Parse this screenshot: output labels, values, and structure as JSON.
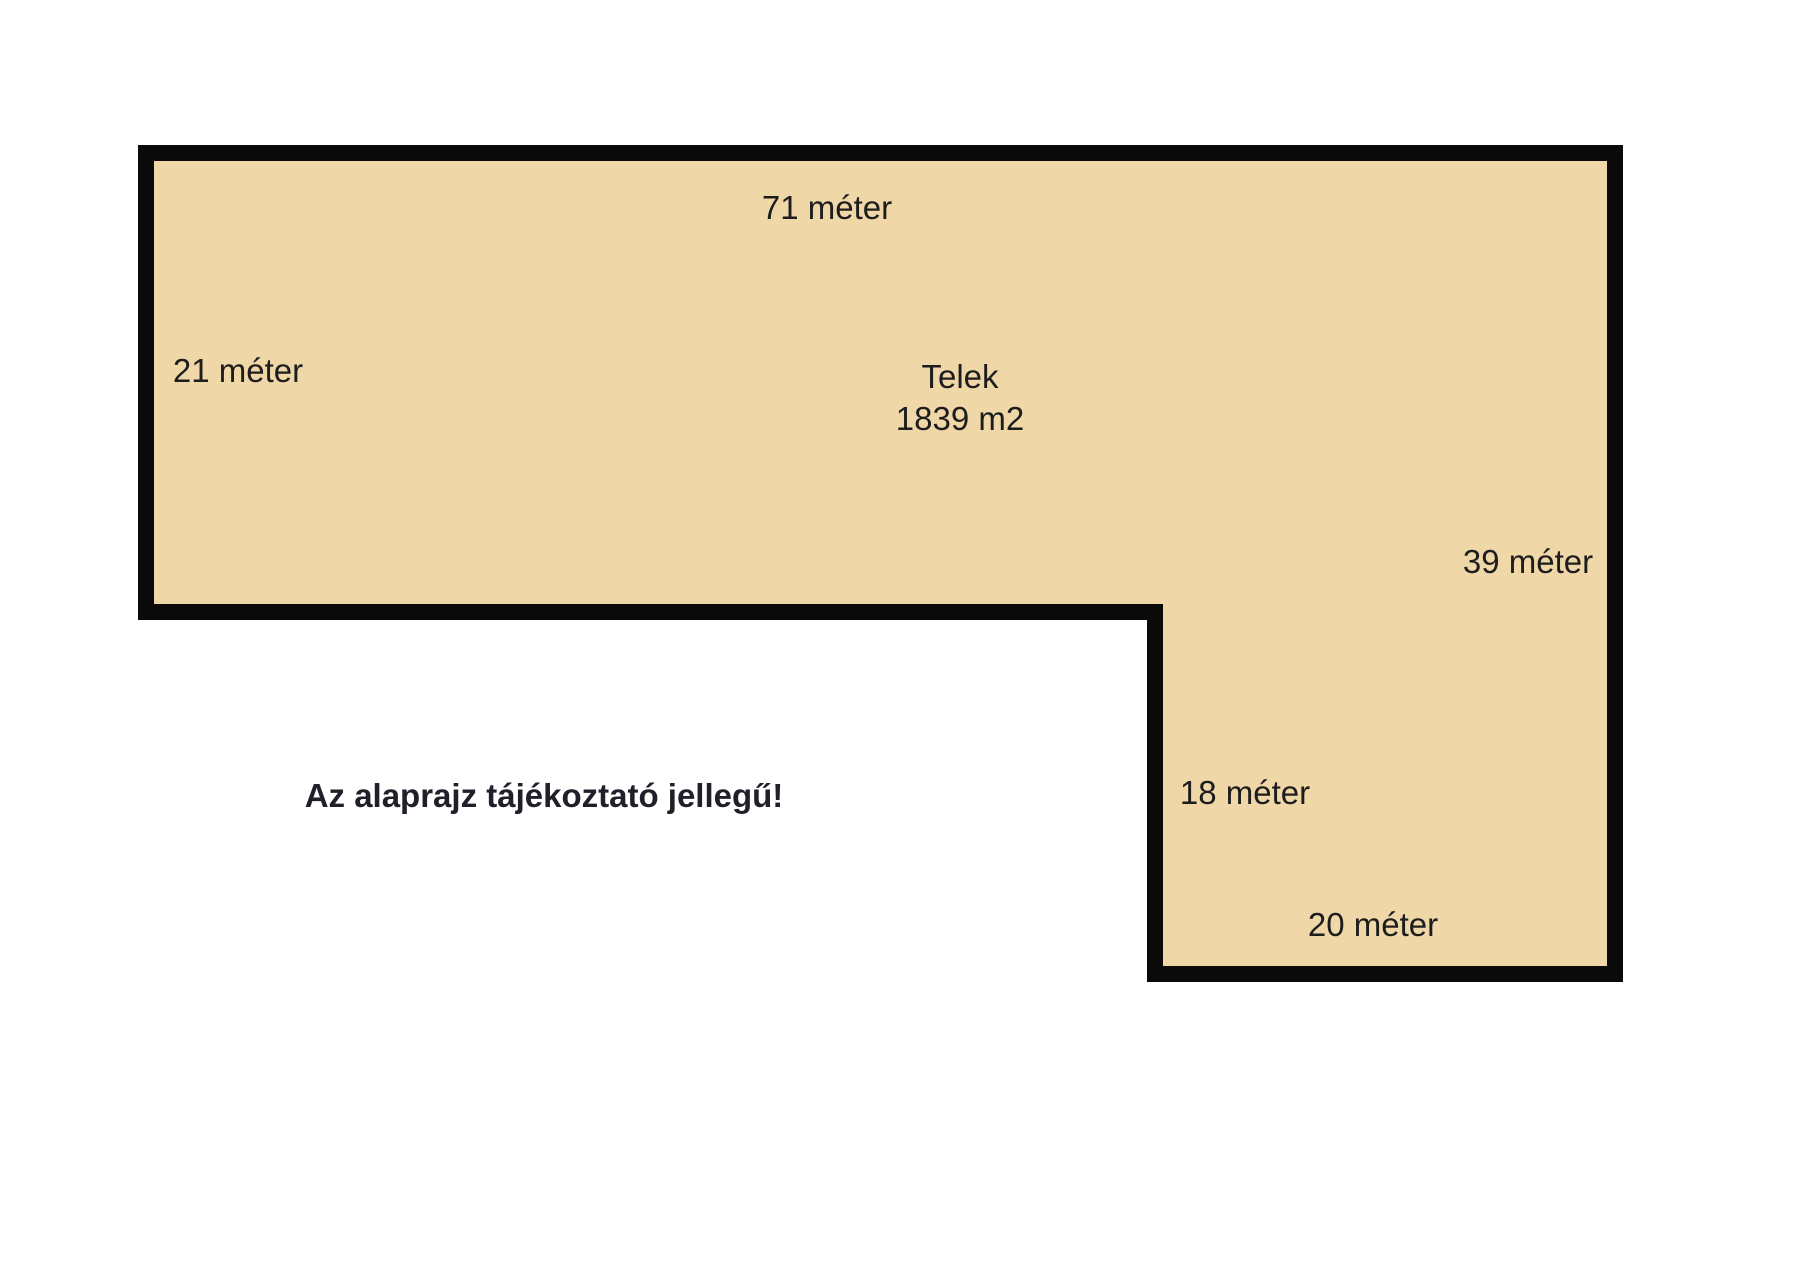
{
  "page": {
    "background_color": "#ffffff"
  },
  "plot": {
    "fill_color": "#f0d7a8",
    "outline_color": "#0a0a0a",
    "name": "Telek",
    "area": "1839 m2",
    "dimensions": {
      "top": "71 méter",
      "left": "21 méter",
      "right": "39 méter",
      "inner_vertical": "18 méter",
      "bottom": "20 méter"
    }
  },
  "disclaimer": "Az alaprajz tájékoztató jellegű!"
}
